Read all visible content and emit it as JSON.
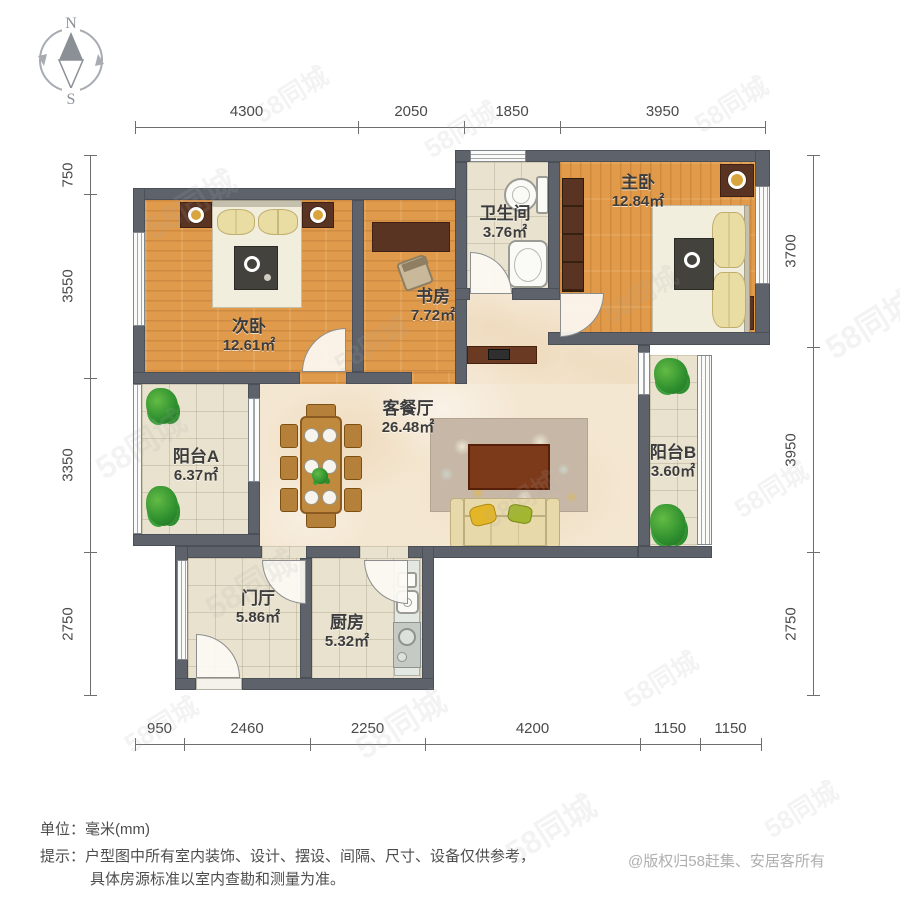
{
  "compass": {
    "north": "N",
    "south": "S"
  },
  "dimensions": {
    "top": {
      "labels": [
        "4300",
        "2050",
        "1850",
        "3950"
      ]
    },
    "left": {
      "labels": [
        "750",
        "3550",
        "3350",
        "2750"
      ]
    },
    "right": {
      "labels": [
        "3700",
        "3950",
        "2750"
      ]
    },
    "bottom": {
      "labels": [
        "950",
        "2460",
        "2250",
        "4200",
        "1150",
        "1150"
      ]
    }
  },
  "rooms": {
    "bedroom2": {
      "name": "次卧",
      "area": "12.61㎡"
    },
    "study": {
      "name": "书房",
      "area": "7.72㎡"
    },
    "bath": {
      "name": "卫生间",
      "area": "3.76㎡"
    },
    "master": {
      "name": "主卧",
      "area": "12.84㎡"
    },
    "living": {
      "name": "客餐厅",
      "area": "26.48㎡"
    },
    "balconyA": {
      "name": "阳台A",
      "area": "6.37㎡"
    },
    "balconyB": {
      "name": "阳台B",
      "area": "3.60㎡"
    },
    "hall": {
      "name": "门厅",
      "area": "5.86㎡"
    },
    "kitchen": {
      "name": "厨房",
      "area": "5.32㎡"
    }
  },
  "notes": {
    "unit": "单位：毫米(mm)",
    "tip1": "提示：户型图中所有室内装饰、设计、摆设、间隔、尺寸、设备仅供参考，",
    "tip2": "具体房源标准以室内查勘和测量为准。"
  },
  "copyright": "@版权归58赶集、安居客所有",
  "watermark": "58同城",
  "colors": {
    "wall": "#5e636b",
    "wood_floor": "#df9a4c",
    "tile_floor": "#e9e2cf",
    "living_floor": "#f4e7d2",
    "dim_text": "#4a4a4a"
  }
}
